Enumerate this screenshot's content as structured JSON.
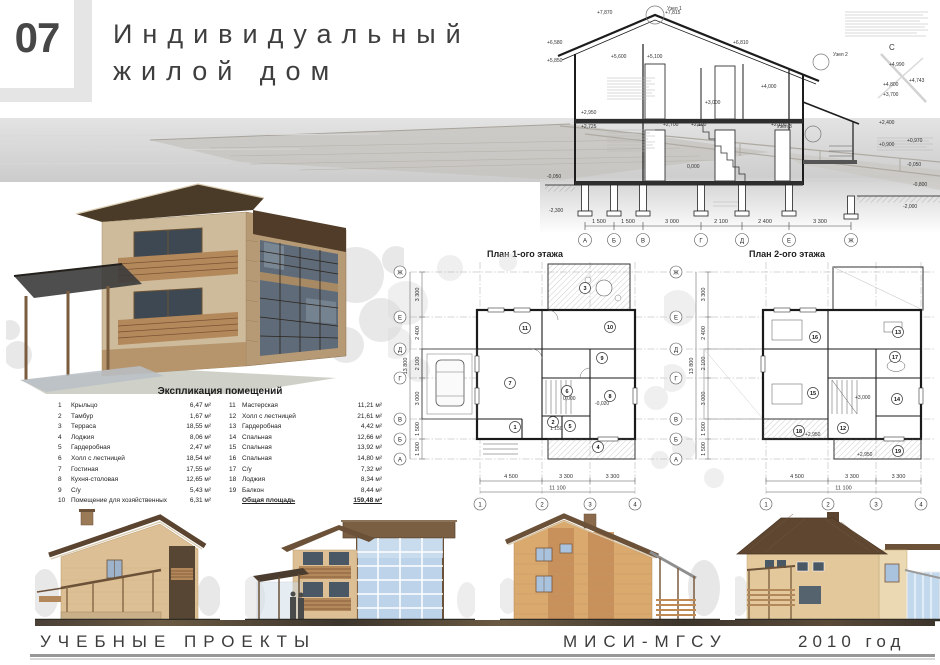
{
  "header": {
    "number": "07",
    "title_line1": "Индивидуальный",
    "title_line2": "жилой дом"
  },
  "section": {
    "north": "С",
    "nodes": [
      "Узел 1",
      "Узел 2",
      "Узел 3"
    ],
    "lv_top": [
      "+7,870",
      "+7,815",
      "+6,810"
    ],
    "lv_left": [
      "+6,580",
      "+5,850",
      "+2,950",
      "+2,725",
      "-0,050",
      "-2,300"
    ],
    "lv_mid": [
      "+5,600",
      "+5,100",
      "+3,000",
      "+4,000",
      "+2,700",
      "+2,100",
      "+2,100",
      "0,000"
    ],
    "lv_right": [
      "+4,990",
      "+4,800",
      "+4,743",
      "+3,700",
      "+2,400",
      "+0,900",
      "+0,970",
      "-0,050",
      "-0,800",
      "-2,000"
    ],
    "axes": [
      "А",
      "Б",
      "В",
      "Г",
      "Д",
      "Е",
      "Ж"
    ],
    "dims": [
      "1 500",
      "1 500",
      "3 000",
      "2 100",
      "2 400",
      "3 300"
    ]
  },
  "plans": {
    "p1": {
      "title": "План 1-ого этажа",
      "rooms": [
        "1",
        "2",
        "3",
        "4",
        "5",
        "6",
        "7",
        "8",
        "9",
        "10",
        "11"
      ],
      "axes_letters": [
        "Ж",
        "Е",
        "Д",
        "Г",
        "В",
        "Б",
        "А"
      ],
      "axes_numbers": [
        "1",
        "2",
        "3",
        "4"
      ],
      "dims_bottom": [
        "4 500",
        "3 300",
        "3 300"
      ],
      "dim_total": "11 100",
      "dims_left": [
        "3 300",
        "2 400",
        "2 100",
        "3 000",
        "1 500",
        "1 500"
      ],
      "dim_left_total": "13 800",
      "levels": [
        "0,000",
        "-0,020",
        "1 150"
      ]
    },
    "p2": {
      "title": "План 2-ого этажа",
      "rooms": [
        "12",
        "13",
        "14",
        "15",
        "16",
        "17",
        "18",
        "19"
      ],
      "axes_letters": [
        "Ж",
        "Е",
        "Д",
        "Г",
        "В",
        "Б",
        "А"
      ],
      "axes_numbers": [
        "1",
        "2",
        "3",
        "4"
      ],
      "dims_bottom": [
        "4 500",
        "3 300",
        "3 300"
      ],
      "dim_total": "11 100",
      "dims_left": [
        "3 300",
        "2 400",
        "2 100",
        "3 000",
        "1 500",
        "1 500"
      ],
      "dim_left_total": "13 800",
      "levels": [
        "+2,950",
        "+3,000",
        "+2,950"
      ]
    }
  },
  "explication": {
    "title": "Экспликация помещений",
    "left_rows": [
      {
        "num": "1",
        "name": "Крыльцо",
        "area": "6,47 м²"
      },
      {
        "num": "2",
        "name": "Тамбур",
        "area": "1,67 м²"
      },
      {
        "num": "3",
        "name": "Терраса",
        "area": "18,55 м²"
      },
      {
        "num": "4",
        "name": "Лоджия",
        "area": "8,06 м²"
      },
      {
        "num": "5",
        "name": "Гардеробная",
        "area": "2,47 м²"
      },
      {
        "num": "6",
        "name": "Холл с лестницей",
        "area": "18,54 м²"
      },
      {
        "num": "7",
        "name": "Гостиная",
        "area": "17,55 м²"
      },
      {
        "num": "8",
        "name": "Кухня-столовая",
        "area": "12,65 м²"
      },
      {
        "num": "9",
        "name": "С/у",
        "area": "5,43 м²"
      },
      {
        "num": "10",
        "name": "Помещение для хозяйственных работ",
        "area": "6,31 м²"
      }
    ],
    "right_rows": [
      {
        "num": "11",
        "name": "Мастерская",
        "area": "11,21 м²"
      },
      {
        "num": "12",
        "name": "Холл с лестницей",
        "area": "21,61 м²"
      },
      {
        "num": "13",
        "name": "Гардеробная",
        "area": "4,42 м²"
      },
      {
        "num": "14",
        "name": "Спальная",
        "area": "12,66 м²"
      },
      {
        "num": "15",
        "name": "Спальная",
        "area": "13,92 м²"
      },
      {
        "num": "16",
        "name": "Спальная",
        "area": "14,80 м²"
      },
      {
        "num": "17",
        "name": "С/у",
        "area": "7,32 м²"
      },
      {
        "num": "18",
        "name": "Лоджия",
        "area": "8,34 м²"
      },
      {
        "num": "19",
        "name": "Балкон",
        "area": "8,44 м²"
      }
    ],
    "total_label": "Общая площадь",
    "total_value": "159,48 м²"
  },
  "footer": {
    "left": "УЧЕБНЫЕ ПРОЕКТЫ",
    "center": "МИСИ-МГСУ",
    "right": "2010 год"
  },
  "colors": {
    "band_gray": "#e5e5e5",
    "ink": "#3d3d3d",
    "roof_brown": "#5a4430",
    "wall_tan": "#dcbf94",
    "brick_orange": "#c48d58",
    "glass_light": "#bcd3ea",
    "glass_dark": "#5f6b78",
    "wood": "#b3885a"
  }
}
